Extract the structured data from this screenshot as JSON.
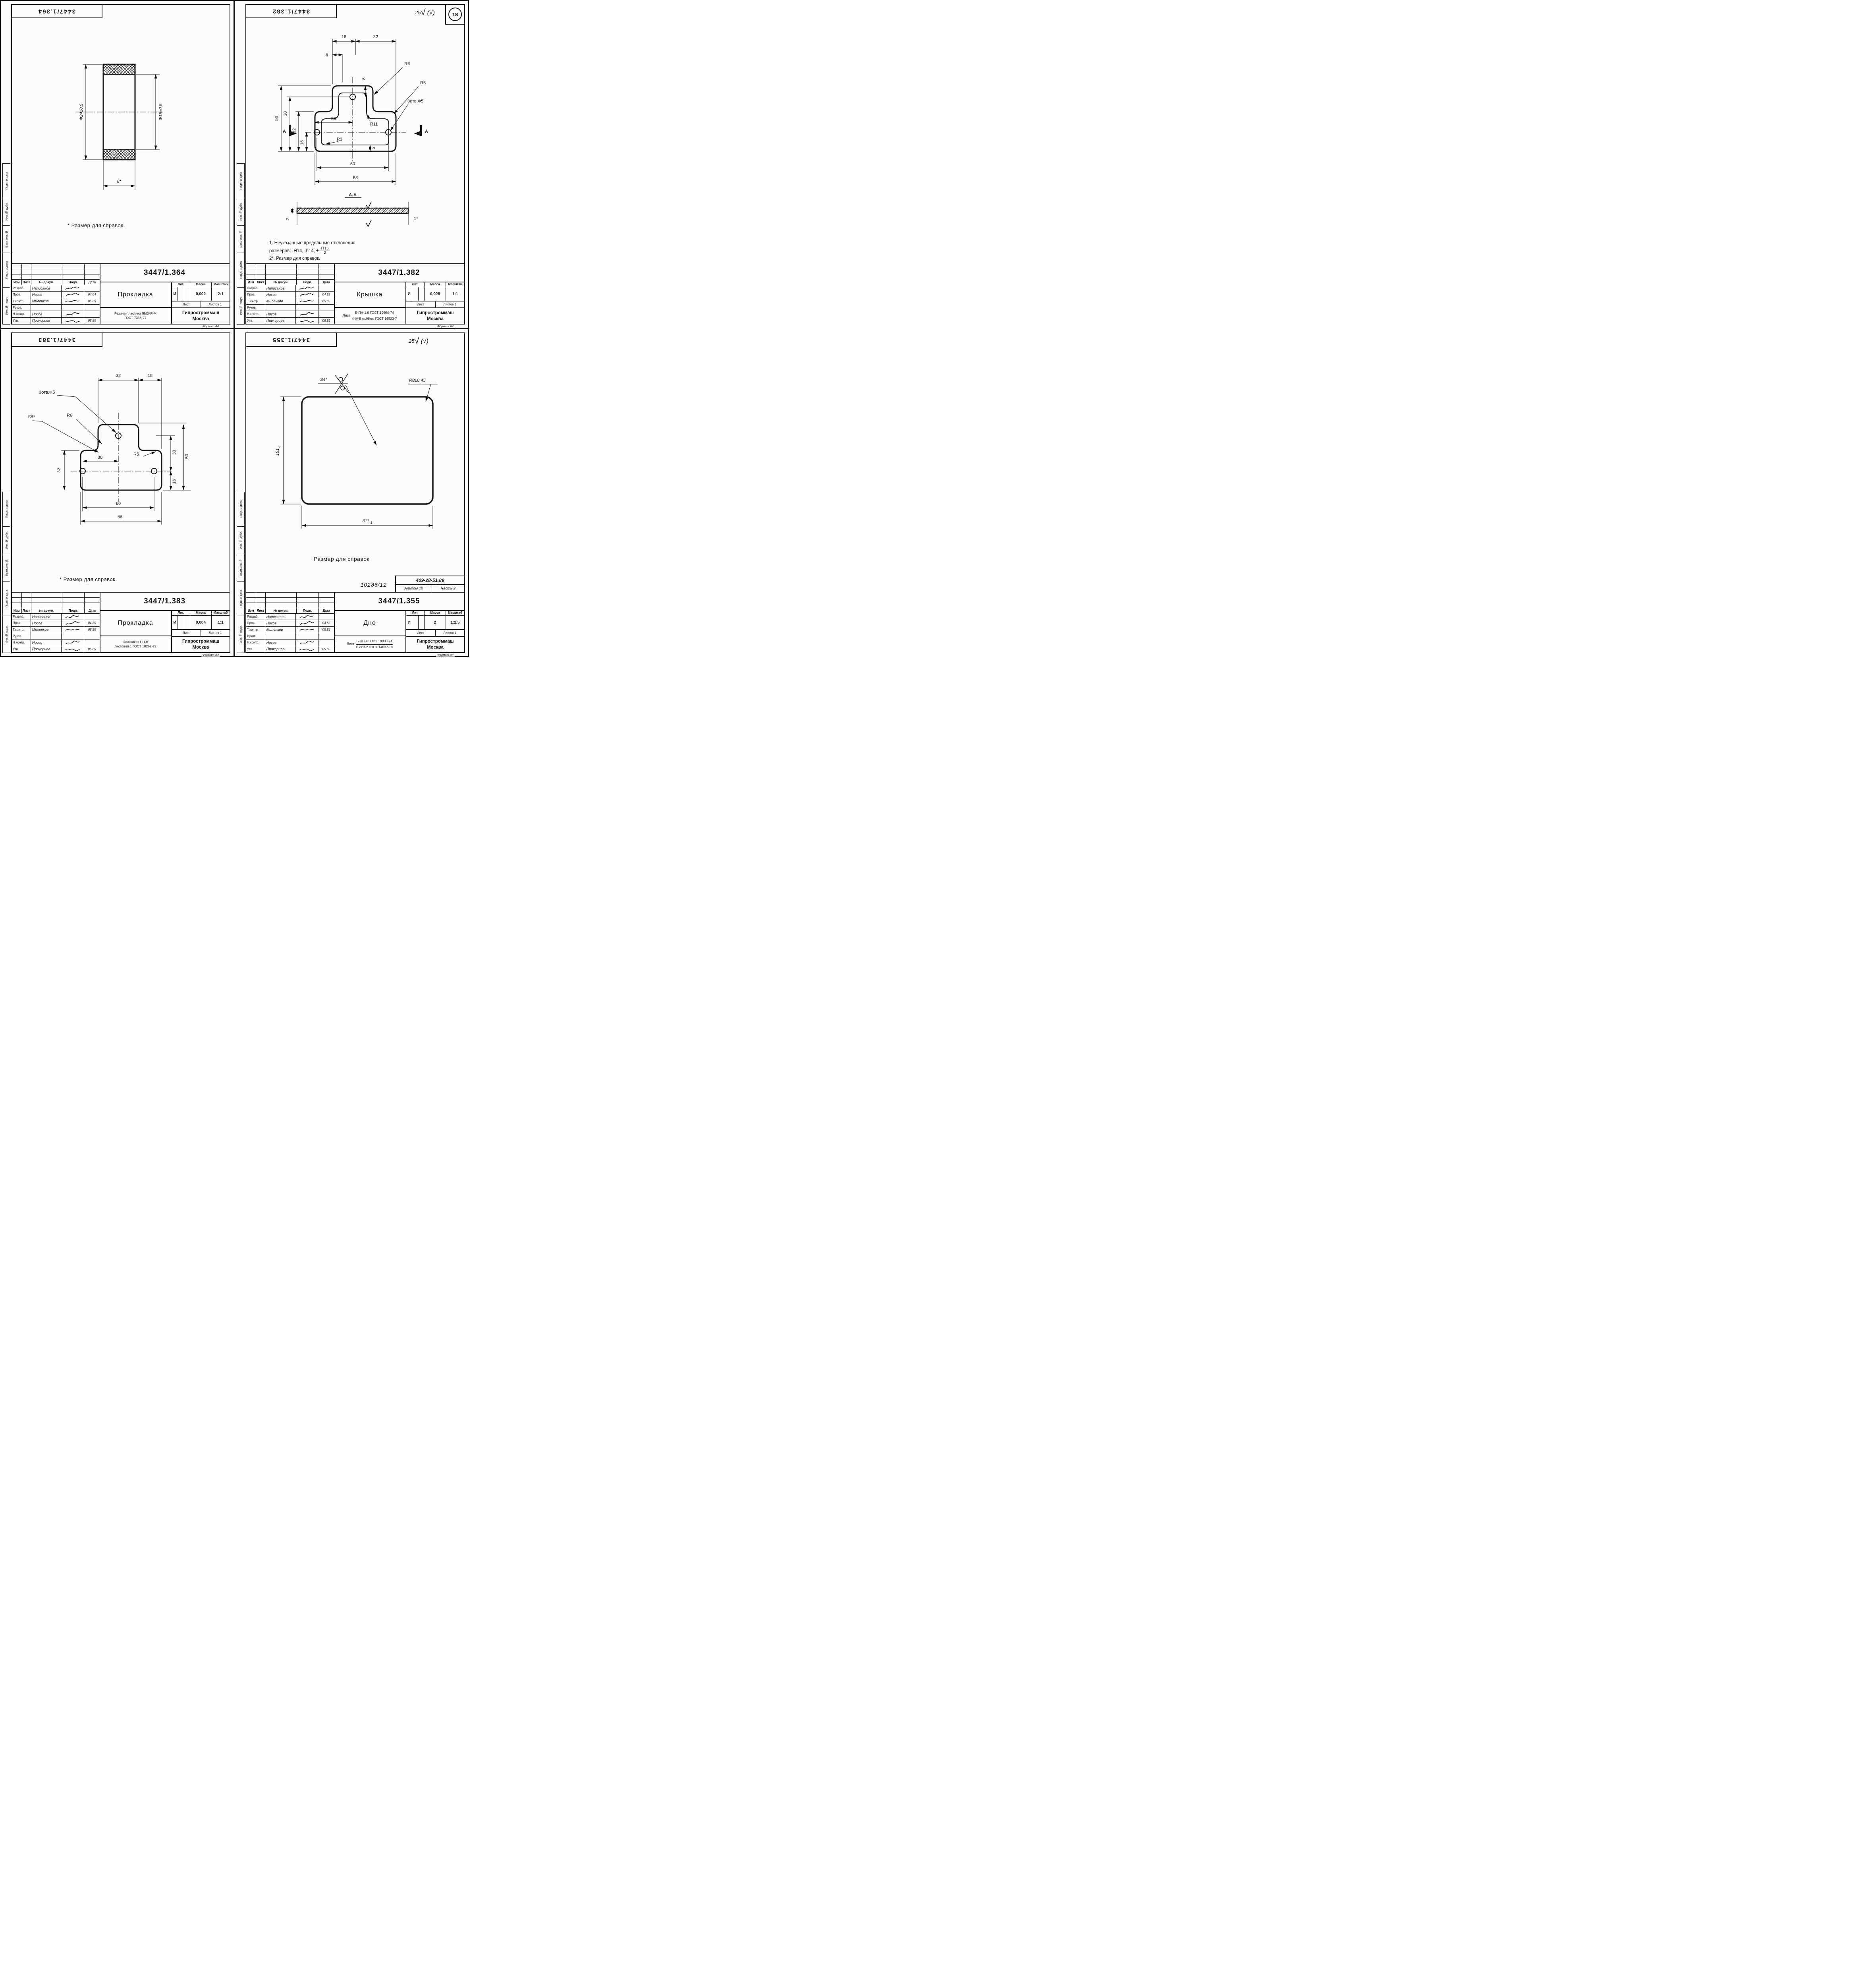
{
  "tb": {
    "izm": "Изм",
    "list": "Лист",
    "doc": "№ докум.",
    "podp": "Подп.",
    "data": "Дата",
    "lit": "Лит.",
    "massa": "Масса",
    "masshtab": "Масштаб",
    "sheet": "Лист",
    "listov": "Листов 1",
    "format": "Формат А4"
  },
  "org": {
    "l1": "Гипростроммаш",
    "l2": "Москва"
  },
  "margin_labels": [
    "Подп. и дата",
    "Инв.№ дубл.",
    "Взам.инв.№",
    "Подп. и дата",
    "Инв.№ подл."
  ],
  "sheets": [
    {
      "doc_number": "3447/1.364",
      "name": "Прокладка",
      "lit": "И",
      "mass": "0,002",
      "scale": "2:1",
      "material_line1": "Резина-пластина 8МБ-Я-М",
      "material_line2": "ГОСТ 7338-77",
      "note": "* Размер для справок.",
      "rows": [
        {
          "role": "Разраб.",
          "name": "Написанов",
          "date": ""
        },
        {
          "role": "Пров.",
          "name": "Носов",
          "date": "04.84"
        },
        {
          "role": "Т.контр.",
          "name": "Миленков",
          "date": "05.85"
        },
        {
          "role": "Руков.",
          "name": "",
          "date": ""
        },
        {
          "role": "Н.контр.",
          "name": "Носов",
          "date": ""
        },
        {
          "role": "Утв.",
          "name": "Прохорцев",
          "date": "05.85"
        }
      ],
      "drawing": {
        "dia_outer": "Ф24±0,5",
        "dia_inner": "Ф19±0,5",
        "width": "8*"
      }
    },
    {
      "doc_number": "3447/1.382",
      "name": "Крышка",
      "lit": "И",
      "mass": "0,028",
      "scale": "1:1",
      "material_prefix": "Лист",
      "material_line1": "Б-ПН-1,0 ГОСТ 19904-74",
      "material_line2": "4-IV-В ст.08кп. ГОСТ 16523-7",
      "corner": {
        "rough": "25",
        "check": "√",
        "paren": "(√)",
        "badge": "18"
      },
      "notes": {
        "l1": "1. Неуказанные предельные отклонения",
        "l2": "размеров: -Н14, -h14, ±",
        "ft": "IT16",
        "fb": "2",
        "l3": "2*. Размер для справок."
      },
      "rows": [
        {
          "role": "Разраб.",
          "name": "Написанов",
          "date": ""
        },
        {
          "role": "Пров.",
          "name": "Носов",
          "date": "04.85"
        },
        {
          "role": "Т.контр.",
          "name": "Миленков",
          "date": "05.85"
        },
        {
          "role": "Руков.",
          "name": "",
          "date": ""
        },
        {
          "role": "Н.контр.",
          "name": "Носов",
          "date": ""
        },
        {
          "role": "Утв.",
          "name": "Прохорцев",
          "date": "06.85"
        }
      ],
      "drawing": {
        "top_8": "8",
        "top_18": "18",
        "top_32": "32",
        "left_50": "50",
        "left_30": "30",
        "left_32": "32",
        "left_16": "16",
        "in_30": "30",
        "in_8": "8",
        "in_5": "5",
        "r6": "R6",
        "r5": "R5",
        "r11": "R11",
        "r3": "R3",
        "holes": "3отв.Ф5",
        "b_60": "60",
        "b_68": "68",
        "sec": "А-А",
        "a": "А",
        "t_2": "2",
        "t_1": "1*"
      }
    },
    {
      "doc_number": "3447/1.383",
      "name": "Прокладка",
      "lit": "И",
      "mass": "0,004",
      "scale": "1:1",
      "material_line1": "Пластикат ПП-В",
      "material_line2": "листовой 1 ГОСТ 18269-72",
      "note": "* Размер для справок.",
      "rows": [
        {
          "role": "Разраб.",
          "name": "Написанов",
          "date": ""
        },
        {
          "role": "Пров.",
          "name": "Носов",
          "date": "04.85"
        },
        {
          "role": "Т.контр.",
          "name": "Миленков",
          "date": "05.85"
        },
        {
          "role": "Руков.",
          "name": "",
          "date": ""
        },
        {
          "role": "Н.контр.",
          "name": "Носов",
          "date": ""
        },
        {
          "role": "Утв.",
          "name": "Прохорцев",
          "date": "05.85"
        }
      ],
      "drawing": {
        "top_32": "32",
        "top_18": "18",
        "left_32": "32",
        "in_30": "30",
        "r_30": "30",
        "r_16": "16",
        "r_50": "50",
        "r6": "R6",
        "r5": "R5",
        "holes": "3отв.Ф5",
        "s": "S6*",
        "b_60": "60",
        "b_68": "68"
      }
    },
    {
      "doc_number": "3447/1.355",
      "name": "Дно",
      "lit": "И",
      "mass": "2",
      "scale": "1:2,5",
      "material_prefix": "Лист",
      "material_line1": "Б-ПН-4 ГОСТ 19903-74",
      "material_line2": "В ст.3-2 ГОСТ 14637-79",
      "corner": {
        "rough": "25",
        "check": "√",
        "paren": "(√)"
      },
      "refs": {
        "code": "409-28-51.89",
        "album": "Альбом 10",
        "part": "Часть 2",
        "hand": "10286/12"
      },
      "note": "Размер для справок",
      "rows": [
        {
          "role": "Разраб.",
          "name": "Написанов",
          "date": ""
        },
        {
          "role": "Пров.",
          "name": "Носов",
          "date": "04.85"
        },
        {
          "role": "Т.контр.",
          "name": "Миленков",
          "date": "05.85"
        },
        {
          "role": "Руков.",
          "name": "",
          "date": ""
        },
        {
          "role": "Н.контр.",
          "name": "Носов",
          "date": ""
        },
        {
          "role": "Утв.",
          "name": "Прохорцев",
          "date": "05.85"
        }
      ],
      "drawing": {
        "h_main": "151",
        "h_sub": "-1",
        "w_main": "311",
        "w_sub": "-1",
        "r": "R8±0,45",
        "s": "S4*"
      }
    }
  ]
}
